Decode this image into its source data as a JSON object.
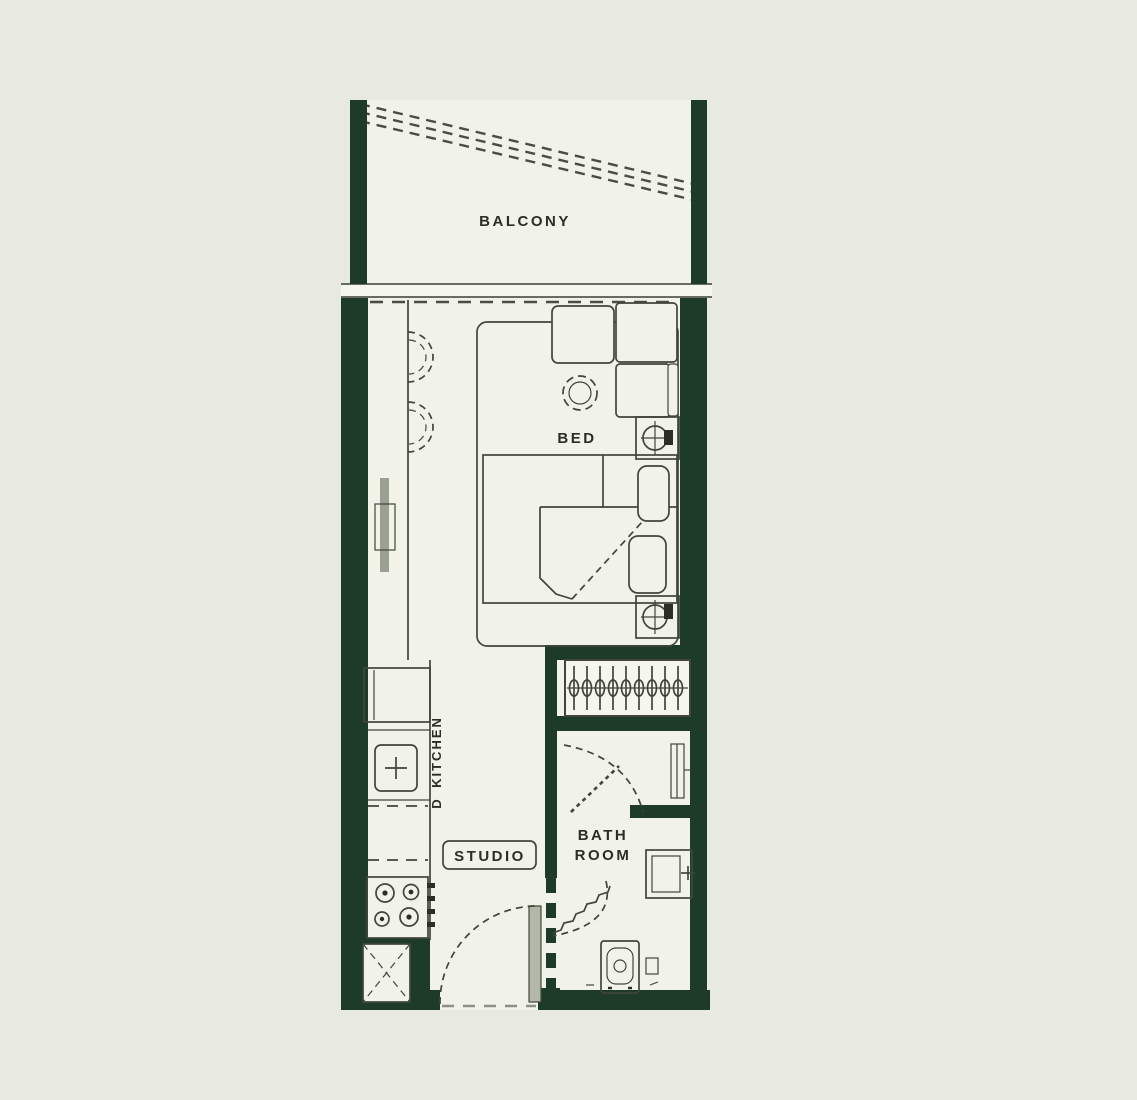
{
  "plan": {
    "type": "apartment-floor-plan",
    "colors": {
      "background": "#e8eadf",
      "wall": "#1e3a28",
      "floor": "#f1f2e8",
      "line": "#41453a",
      "door_leaf": "#b3b7a9"
    },
    "labels": {
      "balcony": "BALCONY",
      "bed": "BED",
      "kitchen": "KITCHEN",
      "kitchen_marker": "D",
      "studio": "STUDIO",
      "bathroom_line1": "BATH",
      "bathroom_line2": "ROOM"
    },
    "icons": {
      "seating": [
        "sofa-icon",
        "pouf-table-icon",
        "bar-chair-icon"
      ],
      "bedroom": [
        "bed-icon",
        "pillow-icon",
        "tv-icon",
        "fan-unit-icon"
      ],
      "kitchen": [
        "refrigerator-icon",
        "sink-icon",
        "cooktop-icon",
        "shaft-x-icon"
      ],
      "bathroom": [
        "toilet-icon",
        "washbasin-icon",
        "towel-rail-icon",
        "shower-door-icon"
      ],
      "storage": [
        "wardrobe-hangers-icon"
      ],
      "doors": [
        "entry-door-swing-icon",
        "bath-door-swing-icon",
        "sliding-door-dashed-icon"
      ]
    }
  }
}
